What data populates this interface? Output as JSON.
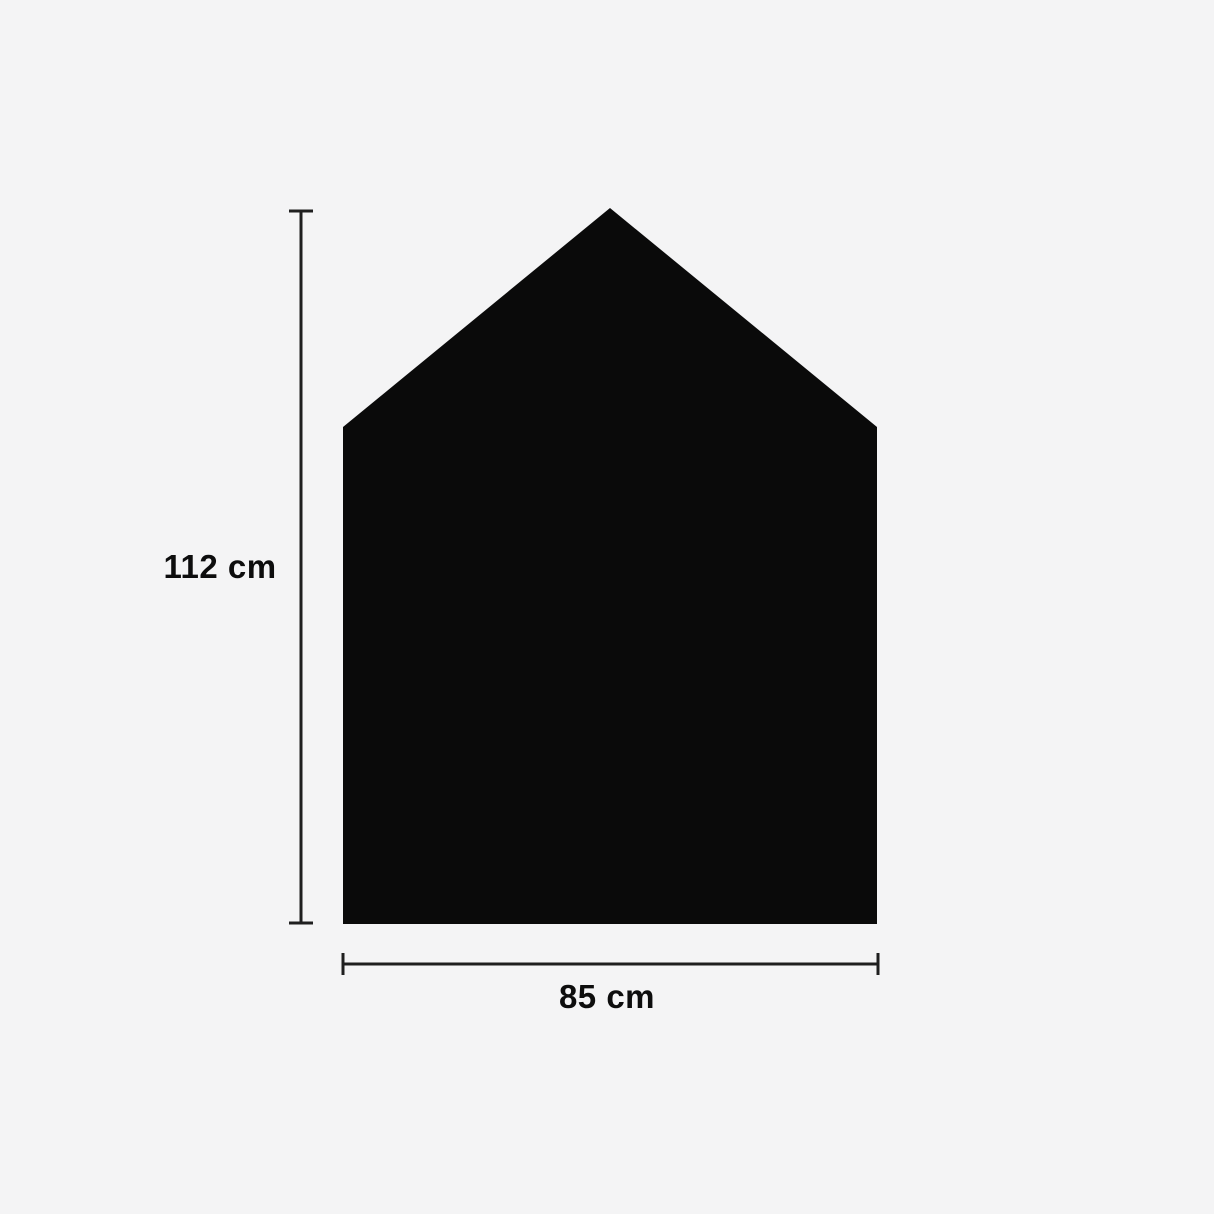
{
  "diagram": {
    "description": "Dimension diagram of a house-shaped black panel",
    "background_color": "#f4f4f5",
    "shape": {
      "name": "house-silhouette",
      "fill_color": "#0a0a0a"
    },
    "dimension_line_color": "#1f1f1f",
    "height_dimension": {
      "label": "112 cm"
    },
    "width_dimension": {
      "label": "85 cm"
    }
  }
}
